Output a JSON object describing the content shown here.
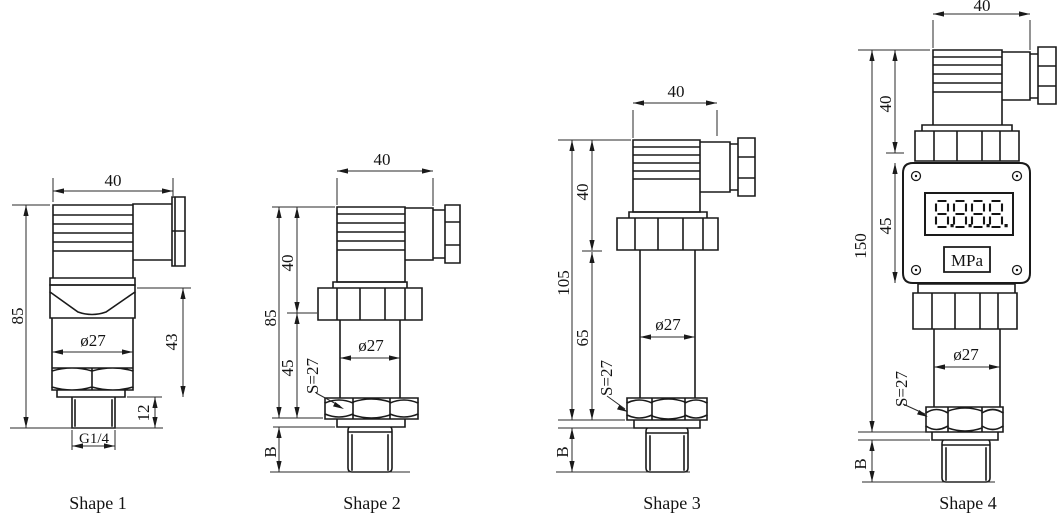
{
  "drawing": {
    "shapes": [
      {
        "label": "Shape 1",
        "dims": {
          "top_width": "40",
          "overall_height": "85",
          "body_height": "43",
          "thread_length": "12",
          "diameter": "ø27",
          "thread_spec": "G1/4"
        }
      },
      {
        "label": "Shape 2",
        "dims": {
          "top_width": "40",
          "overall_height": "85",
          "connector_height": "40",
          "body_height": "45",
          "diameter": "ø27",
          "hex_size": "S=27",
          "thread_length": "B"
        }
      },
      {
        "label": "Shape 3",
        "dims": {
          "top_width": "40",
          "overall_height": "105",
          "connector_height": "40",
          "body_height": "65",
          "diameter": "ø27",
          "hex_size": "S=27",
          "thread_length": "B"
        }
      },
      {
        "label": "Shape 4",
        "dims": {
          "top_width": "40",
          "overall_height": "150",
          "connector_height": "40",
          "display_height": "45",
          "diameter": "ø27",
          "hex_size": "S=27",
          "thread_length": "B"
        },
        "display": {
          "value": "8.8.8.8.",
          "units": "MPa"
        }
      }
    ]
  }
}
